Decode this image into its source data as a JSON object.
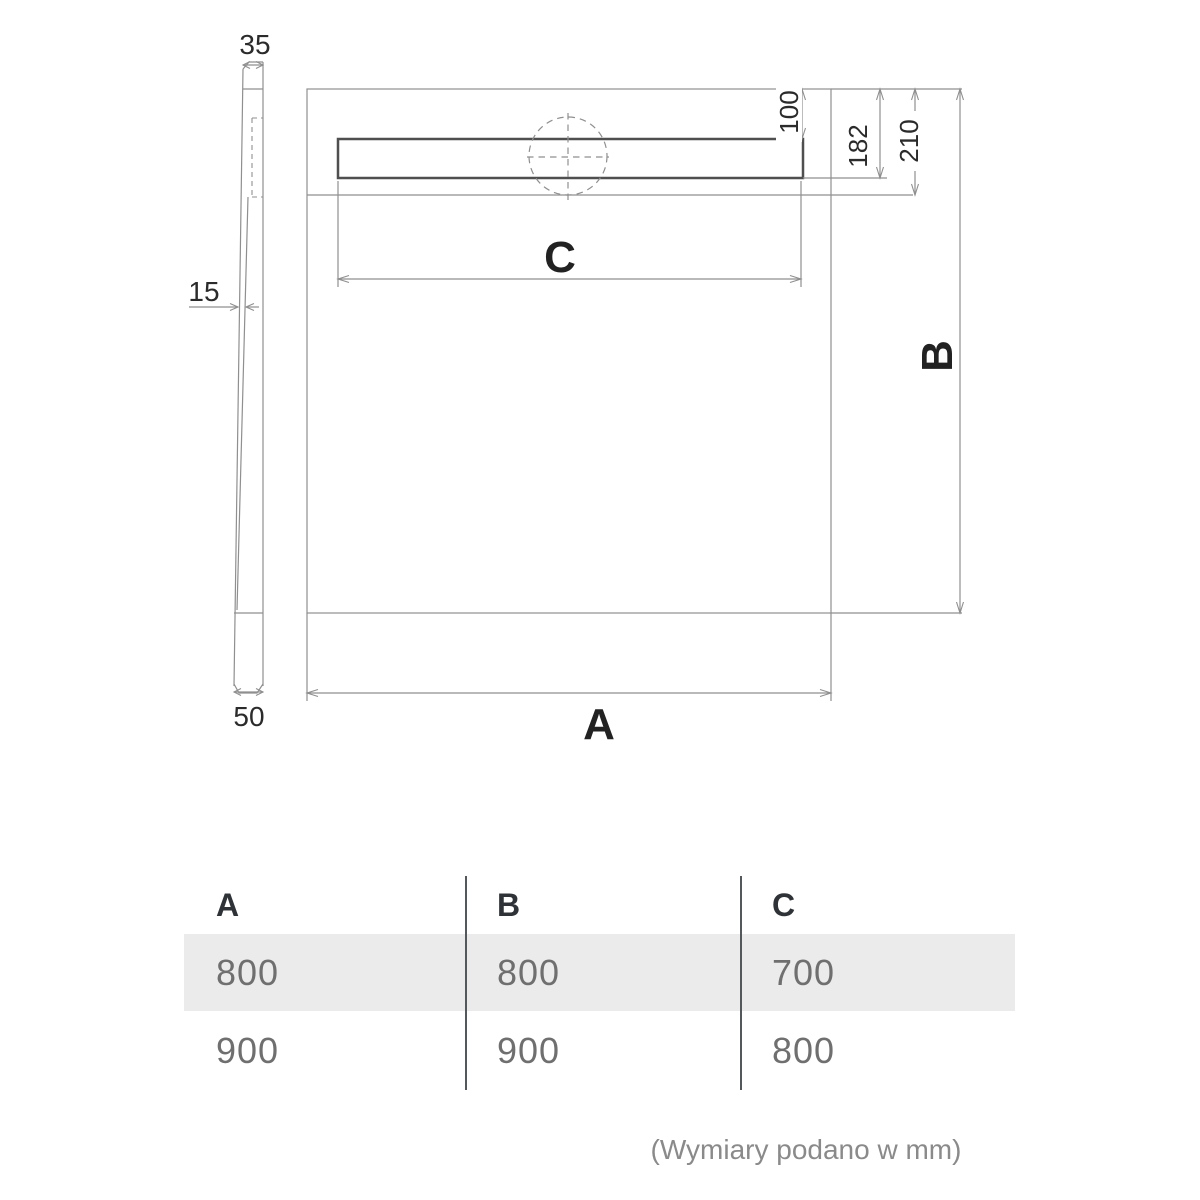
{
  "drawing": {
    "labels": {
      "side_top_thickness": "35",
      "side_bottom_thickness": "50",
      "side_wall_thickness": "15",
      "drain_edge_offset": "100",
      "drain_zone_depth": "182",
      "slope_zone_depth": "210",
      "width": "A",
      "depth": "B",
      "drain_length": "C"
    }
  },
  "table": {
    "headers": [
      {
        "label": "A"
      },
      {
        "label": "B"
      },
      {
        "label": "C"
      }
    ],
    "rows": [
      {
        "cells": [
          "800",
          "800",
          "700"
        ]
      },
      {
        "cells": [
          "900",
          "900",
          "800"
        ]
      }
    ]
  },
  "footer": {
    "note": "(Wymiary podano w mm)"
  },
  "colors": {
    "line": "#8f8f8f",
    "line_dark": "#4f4f4f",
    "text_dark": "#2b2b2b",
    "text_gray": "#6f6f6f",
    "row_bg": "#ebebeb",
    "divider": "#55585b",
    "footer_text": "#8a8a8a",
    "header_text": "#2f3337",
    "bg": "#ffffff"
  }
}
